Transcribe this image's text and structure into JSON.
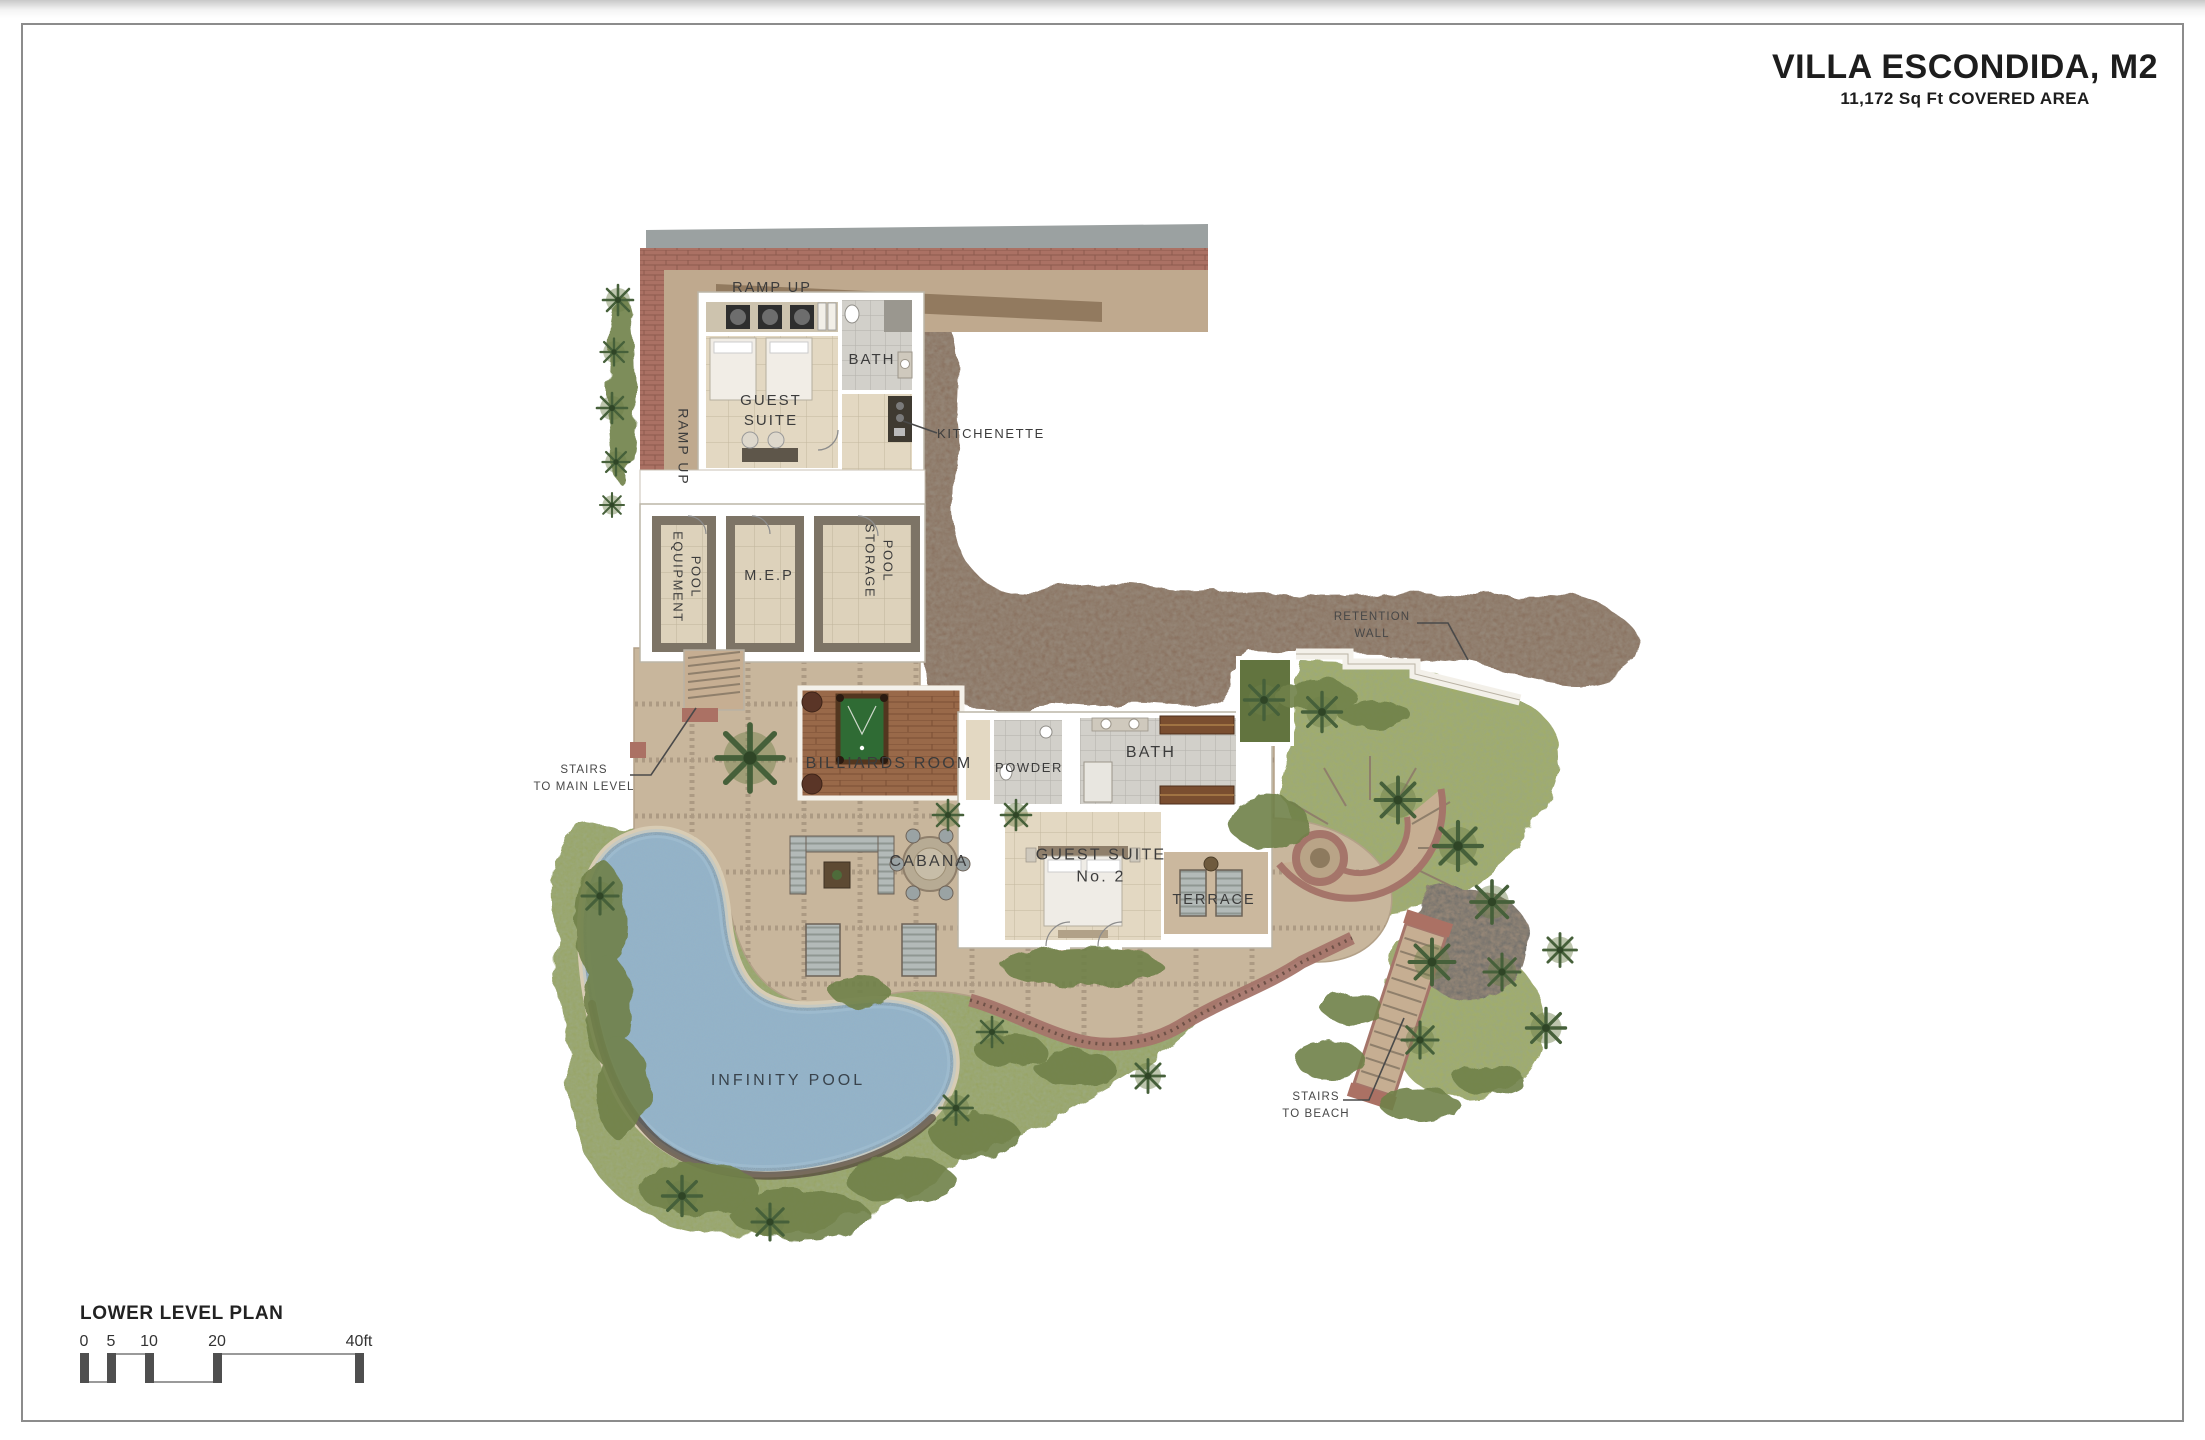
{
  "page": {
    "title": "VILLA ESCONDIDA, M2",
    "subtitle": "11,172 Sq Ft COVERED AREA",
    "plan_name": "LOWER LEVEL PLAN"
  },
  "scale_bar": {
    "ticks": {
      "t0": "0",
      "t5": "5",
      "t10": "10",
      "t20": "20",
      "t40": "40ft"
    }
  },
  "plan": {
    "labels": {
      "ramp_up_top": "RAMP UP",
      "ramp_up_side": "RAMP UP",
      "guest_suite": "GUEST\nSUITE",
      "bath_upper": "BATH",
      "kitchenette": "KITCHENETTE",
      "pool_equipment": "POOL\nEQUIPMENT",
      "mep": "M.E.P",
      "pool_storage": "POOL\nSTORAGE",
      "billiards_room": "BILLIARDS ROOM",
      "powder": "POWDER",
      "bath_lower": "BATH",
      "guest_suite_2": "GUEST SUITE\nNo. 2",
      "cabana": "CABANA",
      "terrace": "TERRACE",
      "infinity_pool": "INFINITY POOL",
      "stairs_main_level": "STAIRS\nTO MAIN LEVEL",
      "stairs_beach": "STAIRS\nTO BEACH",
      "retention_wall": "RETENTION\nWALL"
    }
  },
  "palette": {
    "paper": "#ffffff",
    "frame_border": "#8c8c8c",
    "terrace_stone": "#c8b69c",
    "room_floor": "#e3d8c2",
    "wall": "#ffffff",
    "brick": "#ab7164",
    "dirt_hillside": "#8a7260",
    "grass": "#98a465",
    "lawn": "#a3ad68",
    "pool_water": "#8fb3cb",
    "pool_table_felt": "#2f6b34",
    "wood_floor": "#996949",
    "roof": "#9ba1a1",
    "label_text": "#3c3c3c"
  }
}
